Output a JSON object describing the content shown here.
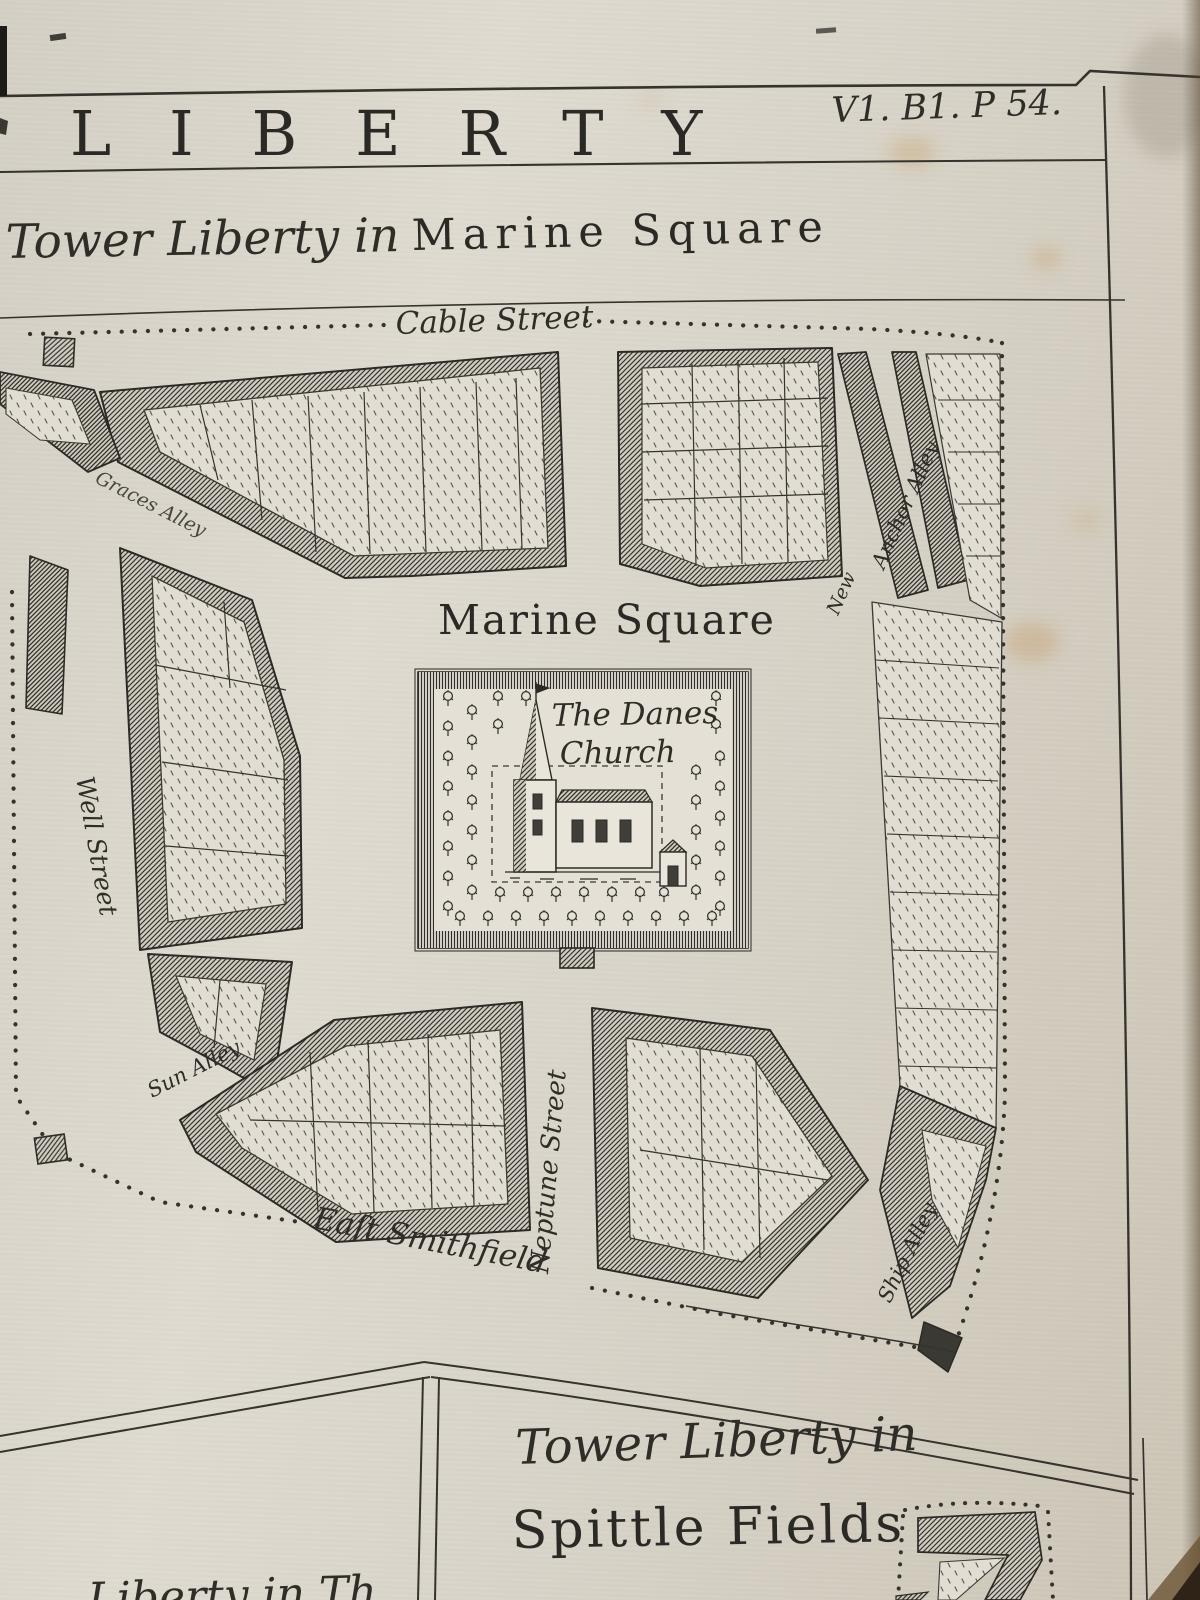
{
  "page": {
    "header_title": "LIBERTY",
    "plate_ref": "V1. B1. P 54.",
    "subtitle_script": "Tower Liberty in",
    "subtitle_roman": "Marine Square"
  },
  "map": {
    "square_label": "Marine Square",
    "church_label": [
      "The Danes",
      "Church"
    ],
    "streets": {
      "cable_street": "Cable Street",
      "well_street": "Well Street",
      "graces_alley": "Graces Alley",
      "sun_alley": "Sun Alley",
      "neptune_street": "Neptune Street",
      "east_smithfield": "Eaſt Smithfield",
      "anchor_alley": "Anchor Alley",
      "new_alley": "New",
      "ship_alley": "Ship Alley"
    }
  },
  "bottom_section": {
    "title_script": "Tower Liberty in",
    "title_roman": "Spittle Fields",
    "cutoff_text": "Liberty in Th"
  },
  "colors": {
    "paper": "#d9d4c9",
    "ink": "#2e2d2b",
    "stain": "#c8a05f"
  }
}
